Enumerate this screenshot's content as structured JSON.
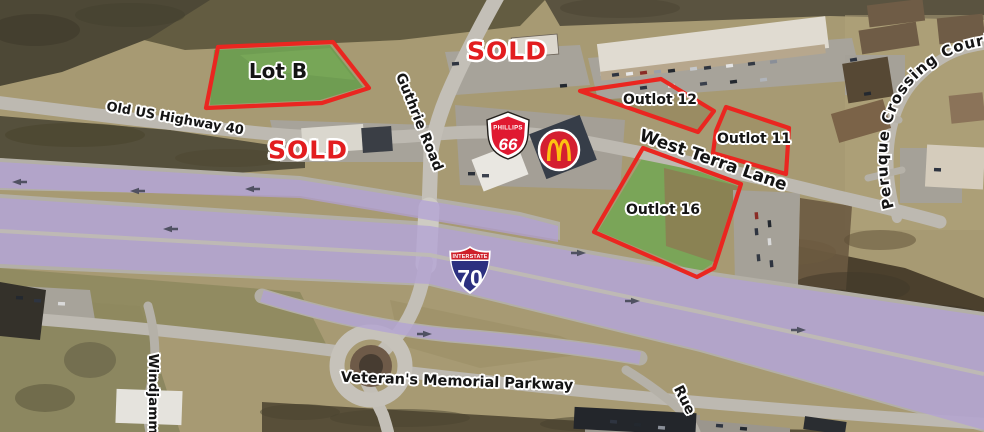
{
  "lots": {
    "lot_b": {
      "label": "Lot B"
    },
    "outlot_12": {
      "label": "Outlot 12"
    },
    "outlot_11": {
      "label": "Outlot 11"
    },
    "outlot_16": {
      "label": "Outlot 16"
    }
  },
  "sold": {
    "north": "SOLD",
    "west": "SOLD"
  },
  "roads": {
    "old_us_highway_40": "Old US Highway 40",
    "guthrie_road": "Guthrie Road",
    "west_terra_lane": "West Terra Lane",
    "peruque_crossing_court": "Peruque Crossing Court",
    "veterans_memorial_parkway": "Veteran's Memorial Parkway",
    "windjammer": "Windjamm",
    "rue": "Rue"
  },
  "shields": {
    "interstate": {
      "caption": "INTERSTATE",
      "number": "70"
    },
    "phillips66": {
      "brand": "PHILLIPS",
      "number": "66"
    }
  },
  "icons": {
    "mcdonalds": "mcdonalds-golden-arches",
    "interstate_shield": "interstate-70-shield",
    "phillips_shield": "phillips-66-shield"
  },
  "colors": {
    "annotation_red": "#ea2620",
    "sold_red": "#e21d1f",
    "highway_overlay_purple": "#b1a0d7",
    "interstate_blue": "#2c3080",
    "interstate_red": "#ce2029",
    "phillips_red": "#e01931",
    "mcdonalds_red": "#d41f30",
    "arches_gold": "#fdc211"
  }
}
